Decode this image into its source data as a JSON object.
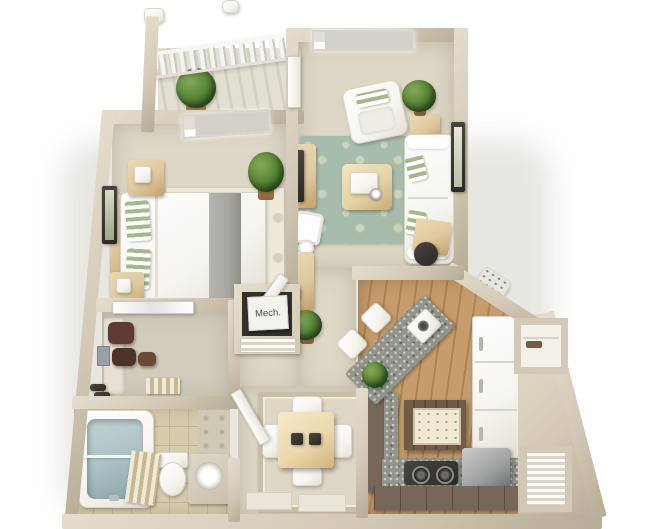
{
  "scene": {
    "description": "3D rendered top-down floor plan of a one-bedroom, one-bathroom apartment with balcony, open living room, dining nook and angled kitchen",
    "background_color": "#ffffff"
  },
  "labels": {
    "mech_room": "Mech."
  },
  "rooms": [
    {
      "name": "balcony",
      "floor": "concrete"
    },
    {
      "name": "living-room",
      "floor": "carpet"
    },
    {
      "name": "bedroom",
      "floor": "carpet"
    },
    {
      "name": "walk-in-closet",
      "floor": "carpet"
    },
    {
      "name": "bathroom",
      "floor": "tile"
    },
    {
      "name": "mechanical-closet",
      "floor": "dark",
      "label": "Mech."
    },
    {
      "name": "hallway",
      "floor": "carpet"
    },
    {
      "name": "dining-area",
      "floor": "carpet"
    },
    {
      "name": "kitchen",
      "floor": "wood"
    },
    {
      "name": "linen-closet",
      "floor": "white"
    },
    {
      "name": "utility-closet",
      "floor": "white"
    }
  ],
  "furniture": [
    "balcony-railing",
    "balcony-plant",
    "queen-bed",
    "nightstands",
    "bedroom-rug",
    "bedroom-window",
    "bedroom-wall-art",
    "bedroom-plant",
    "living-window",
    "armchair",
    "sofa",
    "green-damask-rug",
    "coffee-table",
    "media-console",
    "tv",
    "floor-lamp",
    "side-table",
    "desk",
    "office-chair",
    "living-wall-art",
    "mirror-closet-door",
    "hanging-clothes",
    "shoe-pairs",
    "storage-basket",
    "bathtub",
    "shower-curtain",
    "toilet",
    "vanity-with-mirror",
    "dining-table",
    "dining-chairs",
    "dining-rug",
    "placemats",
    "door-mats",
    "breakfast-bar",
    "bar-stools",
    "bar-sink",
    "kitchen-island",
    "cooktop",
    "dishwasher",
    "refrigerator-cabinet-run",
    "base-cabinets",
    "pantry-shelves",
    "louver-door"
  ],
  "colors": {
    "wall": "#d3c9b6",
    "wall_hi": "#e5ddcc",
    "wall_lo": "#b7ac96",
    "carpet": "#ded7c5",
    "balcony_floor": "#e4dfd3",
    "bedroom_rug": "#ede8d8",
    "rug_pat": "#d9d1ba",
    "living_rug": "#a8bcab",
    "living_rug_pat": "#cbd2ba",
    "dining_rug_border": "#c9bfa4",
    "wood": "#c59c6b",
    "wood_lo": "#ad8352",
    "tile": "#d7cbae",
    "tile_line": "#c3b695",
    "granite": "#90948d",
    "granite_hi": "#c6c8c1",
    "granite_lo": "#60645c",
    "brown_cab": "#77675a",
    "island_wood": "#6f5b49",
    "white_furn": "#f6f4ef",
    "furn_line": "#d9d4c7",
    "tan_furn": "#dfc99f",
    "tan_furn_lo": "#c2a069",
    "green_pillow": "#a4b88c",
    "gray_runner": "#a7a6a1",
    "dark": "#2b2825",
    "maroon": "#5e3a34",
    "water": "#a9c0c3",
    "steel": "#9ea2a0",
    "mech_floor": "#343129",
    "label_bg": "#f4f2ee",
    "label_fg": "#4b4b48",
    "shadow": "#b9b2a2"
  }
}
